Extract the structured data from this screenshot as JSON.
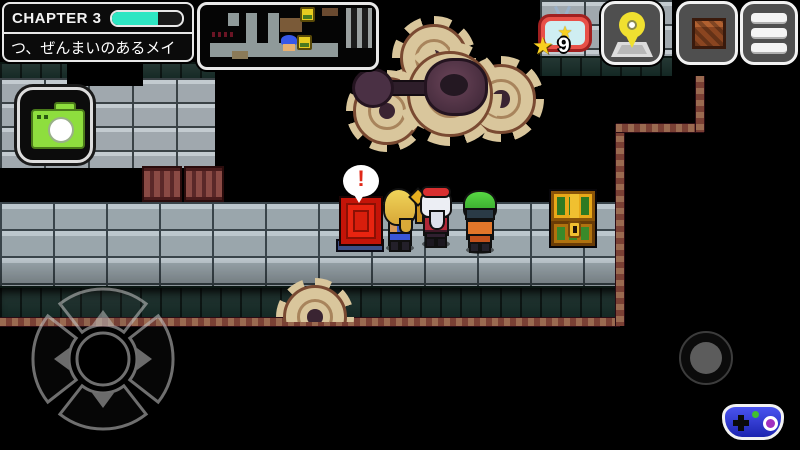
{
  "hud": {
    "chapter": {
      "label": "CHAPTER 3",
      "progress_percent": 65
    },
    "subtitle": "つ、ぜんまいのあるメイ",
    "star_counter": {
      "count": "9",
      "icon": "star-icon",
      "badge_icon": "star-tv-badge-icon"
    },
    "buttons": {
      "map": {
        "icon": "map-pin-icon"
      },
      "storage": {
        "icon": "crate-icon"
      },
      "menu": {
        "icon": "hamburger-icon"
      },
      "camera": {
        "icon": "camera-icon"
      }
    },
    "minimap": {
      "markers": [
        "player-marker",
        "chest-marker",
        "chest-marker"
      ]
    }
  },
  "scene": {
    "speech_bubble_text": "!",
    "objects": [
      "gear-cluster",
      "wind-up-gates",
      "red-book-switch",
      "treasure-chest"
    ],
    "characters": [
      "blonde-hero",
      "silver-haired-ally",
      "green-haired-ally"
    ]
  },
  "controls": {
    "dpad": "d-pad",
    "action": "action-button",
    "gamepad": "gamepad-icon"
  },
  "colors": {
    "progress_teal": "#2ee6c3",
    "hud_border": "#eeeeee",
    "button_gray": "#4f4f4f",
    "camera_green": "#8ce03a",
    "pin_yellow": "#f0e030",
    "star_yellow": "#f8d020",
    "badge_red": "#e85048",
    "gamepad_blue": "#2b35dd",
    "brick_gray": "#9aa6ac",
    "gear_tan": "#d9c69c",
    "trim_maroon": "#7a4034",
    "book_red": "#e82410",
    "chest_gold": "#e8a818"
  }
}
